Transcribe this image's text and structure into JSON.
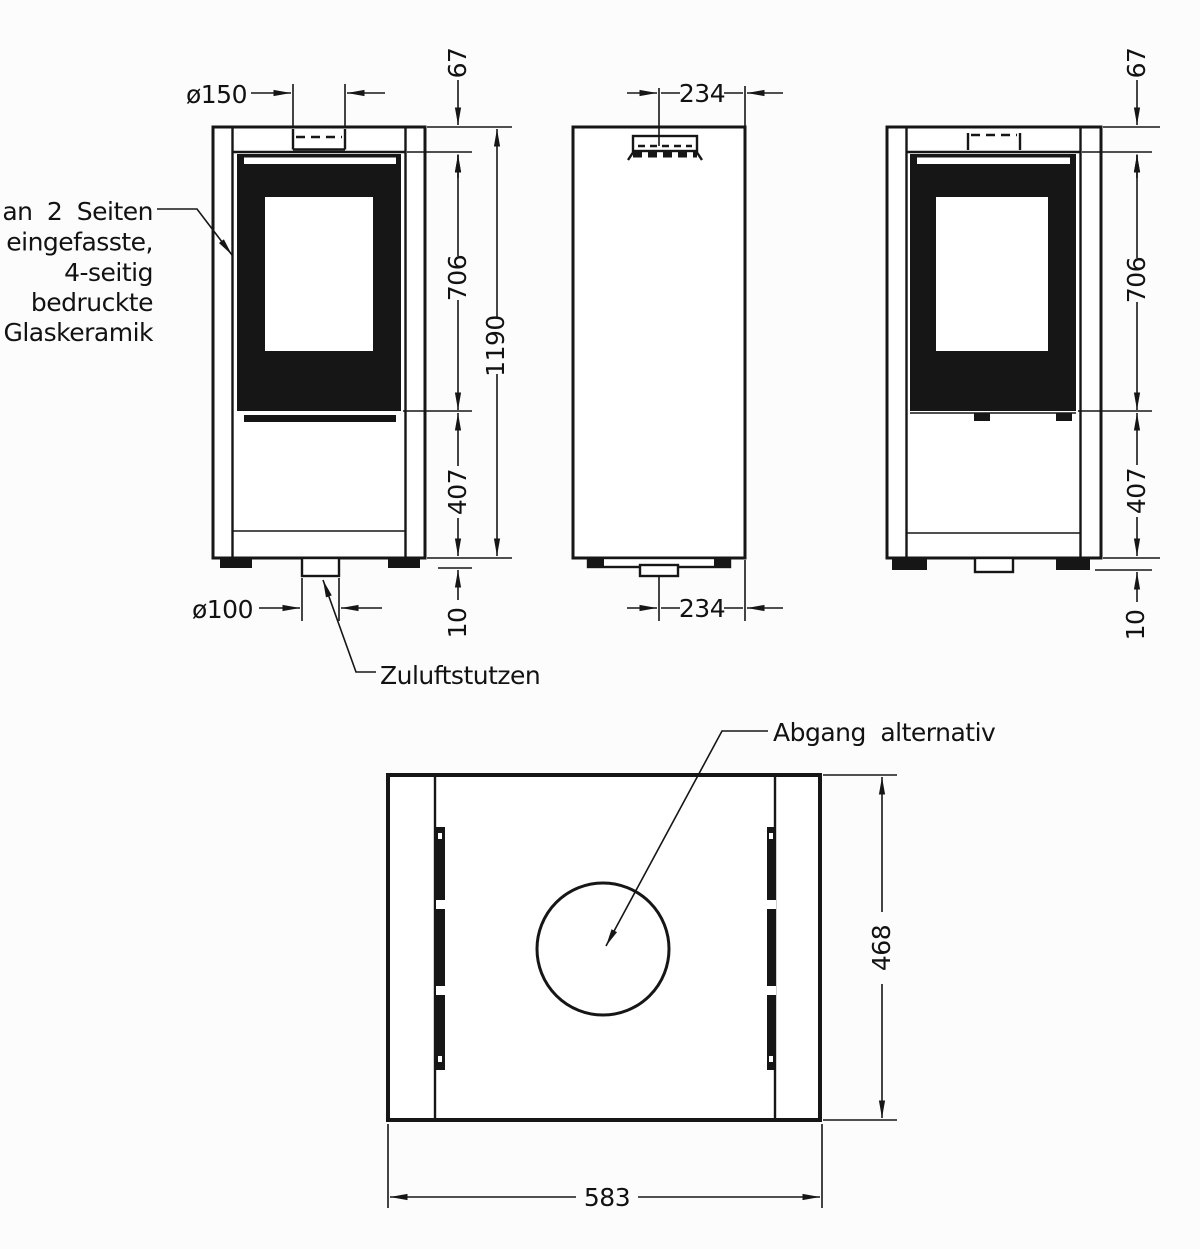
{
  "labels": {
    "glass_note_line1": "an 2 Seiten",
    "glass_note_line2": "eingefasste,",
    "glass_note_line3": "4-seitig",
    "glass_note_line4": "bedruckte",
    "glass_note_line5": "Glaskeramik",
    "air_inlet": "Zuluftstutzen",
    "alt_outlet": "Abgang alternativ"
  },
  "dimensions": {
    "front": {
      "flue_diameter": "ø150",
      "top_to_glass": "67",
      "glass_section": "706",
      "total_height": "1190",
      "lower_section": "407",
      "base_height": "10",
      "air_inlet_diameter": "ø100"
    },
    "side": {
      "flue_offset_top": "234",
      "inlet_offset_bottom": "234"
    },
    "rear": {
      "top_to_glass": "67",
      "glass_section": "706",
      "lower_section": "407",
      "base_height": "10"
    },
    "top": {
      "depth": "468",
      "width": "583"
    }
  }
}
